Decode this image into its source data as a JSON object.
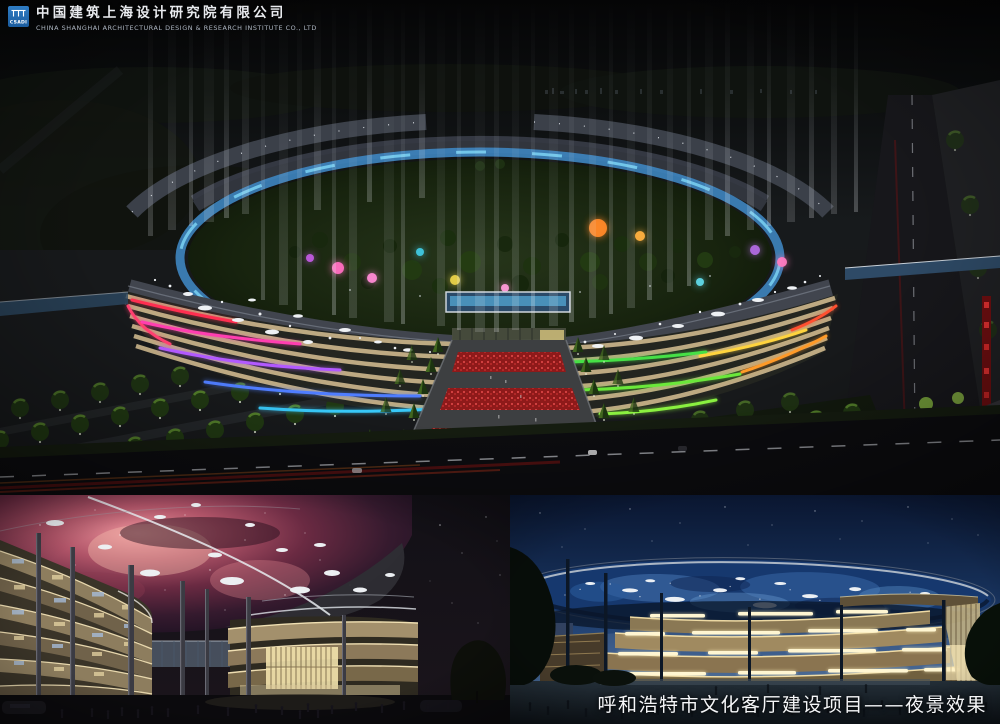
{
  "header": {
    "logo_mark_text": "CSADI",
    "company_name_cn": "中国建筑上海设计研究院有限公司",
    "company_name_en": "CHINA SHANGHAI ARCHITECTURAL DESIGN & RESEARCH INSTITUTE CO., LTD"
  },
  "caption": {
    "project_title": "呼和浩特市文化客厅建设项目——夜景效果"
  },
  "panels": {
    "main": {
      "alt": "Aerial night rendering of elliptical cultural complex with colorful facade lighting and vertical light beams"
    },
    "bottom_left": {
      "alt": "Ground-level night rendering beneath canopy lit with red nebula projection"
    },
    "bottom_right": {
      "alt": "Night elevation rendering with blue starry canopy over warm lit facades"
    }
  },
  "colors": {
    "logo_blue": "#2a72b8",
    "neon_red": "#ff2e50",
    "neon_pink": "#ff3eb0",
    "neon_violet": "#b259ff",
    "neon_blue": "#4f7dff",
    "neon_green": "#46e046",
    "neon_yellow": "#ffd43e",
    "neon_orange": "#ff9a28",
    "canopy_nebula": "#b05468",
    "canopy_starry_blue": "#3a6aaa",
    "facade_warm": "#c6b188",
    "sky_night_blue": "#17325c"
  }
}
